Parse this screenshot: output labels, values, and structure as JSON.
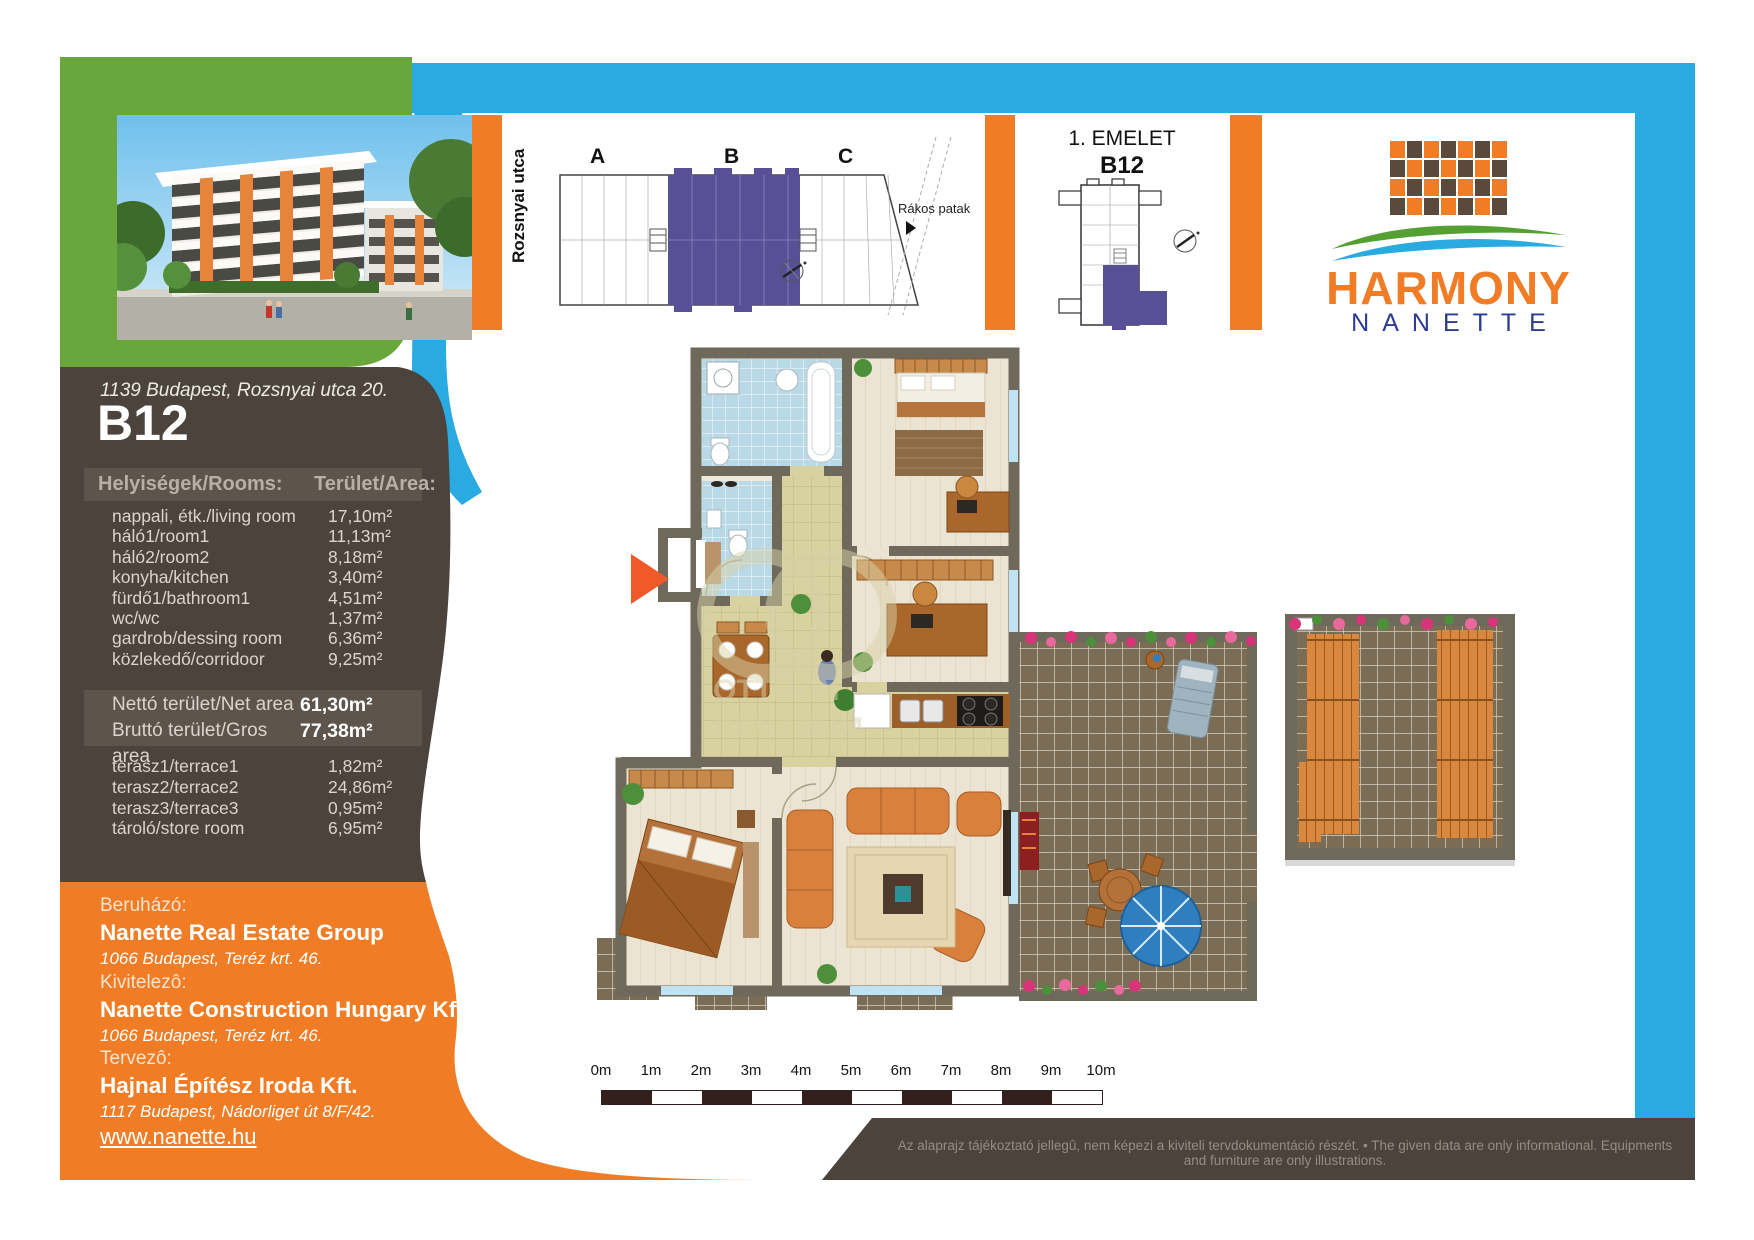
{
  "header": {
    "street_label": "Rozsnyai utca",
    "stream_label": "Rákos  patak",
    "sections": [
      "A",
      "B",
      "C"
    ],
    "floor_title": "1. EMELET",
    "floor_unit": "B12",
    "logo_title": "HARMONY",
    "logo_subtitle": "NANETTE"
  },
  "sidebar": {
    "address": "1139 Budapest, Rozsnyai utca 20.",
    "unit": "B12",
    "table": {
      "col_rooms": "Helyiségek/Rooms:",
      "col_area": "Terület/Area:",
      "rows": [
        {
          "label": "nappali, étk./living room",
          "value": "17,10m²"
        },
        {
          "label": "háló1/room1",
          "value": "11,13m²"
        },
        {
          "label": "háló2/room2",
          "value": "8,18m²"
        },
        {
          "label": "konyha/kitchen",
          "value": "3,40m²"
        },
        {
          "label": "fürdő1/bathroom1",
          "value": "4,51m²"
        },
        {
          "label": "wc/wc",
          "value": "1,37m²"
        },
        {
          "label": "gardrob/dessing room",
          "value": "6,36m²"
        },
        {
          "label": "közlekedő/corridoor",
          "value": "9,25m²"
        }
      ],
      "totals": [
        {
          "label": "Nettó terület/Net area",
          "value": "61,30m²"
        },
        {
          "label": "Bruttó terület/Gros area",
          "value": "77,38m²"
        }
      ],
      "extras": [
        {
          "label": "terasz1/terrace1",
          "value": "1,82m²"
        },
        {
          "label": "terasz2/terrace2",
          "value": "24,86m²"
        },
        {
          "label": "terasz3/terrace3",
          "value": "0,95m²"
        },
        {
          "label": "tároló/store room",
          "value": "6,95m²"
        }
      ]
    },
    "companies": [
      {
        "role": "Beruházó:",
        "name": "Nanette Real Estate Group",
        "address": "1066 Budapest, Teréz krt. 46."
      },
      {
        "role": "Kivitelezô:",
        "name": "Nanette Construction Hungary Kft.",
        "address": "1066 Budapest, Teréz krt. 46."
      },
      {
        "role": "Tervezô:",
        "name": "Hajnal Építész Iroda Kft.",
        "address": "1117 Budapest, Nádorliget út 8/F/42."
      }
    ],
    "website": "www.nanette.hu"
  },
  "footer": {
    "disclaimer": "Az alaprajz tájékoztató jellegû, nem képezi a kiviteli tervdokumentáció részét. • The given data are only informational. Equipments and furniture are only illustrations."
  },
  "scale_bar": {
    "labels": [
      "0m",
      "1m",
      "2m",
      "3m",
      "4m",
      "5m",
      "6m",
      "7m",
      "8m",
      "9m",
      "10m"
    ]
  },
  "colors": {
    "blue": "#29abe2",
    "green": "#69a73d",
    "orange": "#f07d26",
    "brown": "#4c443c",
    "purple": "#575097",
    "arrow": "#f05a28"
  }
}
